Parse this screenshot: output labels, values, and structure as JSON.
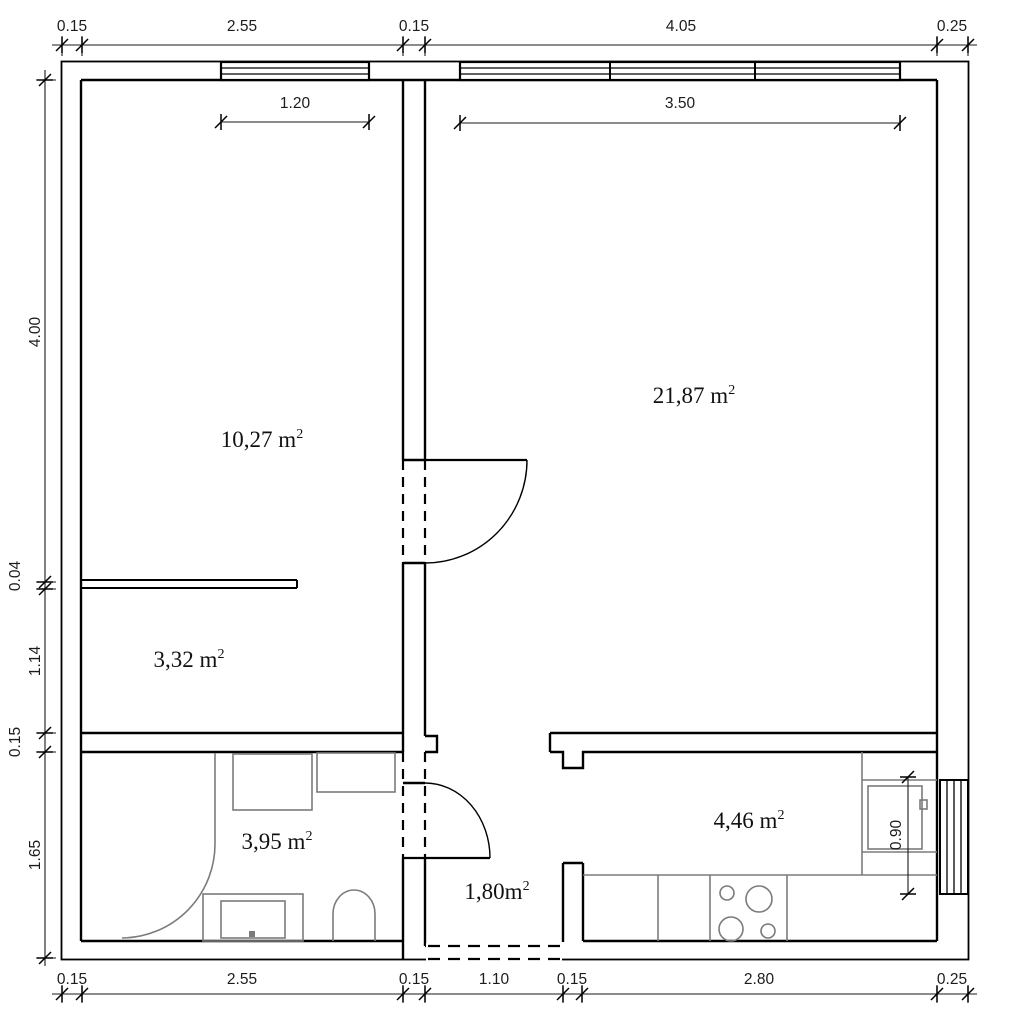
{
  "drawing_title": "apartment-floor-plan",
  "rooms": [
    {
      "id": "room-large-left",
      "area": "10,27 m",
      "sup": "2"
    },
    {
      "id": "living-room",
      "area": "21,87 m",
      "sup": "2"
    },
    {
      "id": "alcove",
      "area": "3,32 m",
      "sup": "2"
    },
    {
      "id": "bathroom",
      "area": "3,95 m",
      "sup": "2"
    },
    {
      "id": "hallway",
      "area": "1,80m",
      "sup": "2"
    },
    {
      "id": "kitchen",
      "area": "4,46 m",
      "sup": "2"
    }
  ],
  "dims": {
    "top": [
      "0.15",
      "2.55",
      "0.15",
      "4.05",
      "0.25"
    ],
    "left": [
      "4.00",
      "0.04",
      "1.14",
      "0.15",
      "1.65"
    ],
    "bottom": [
      "0.15",
      "2.55",
      "0.15",
      "1.10",
      "0.15",
      "2.80",
      "0.25"
    ],
    "interior": {
      "left_window": "1.20",
      "right_window": "3.50",
      "kitchen_sink": "0.90"
    }
  },
  "colors": {
    "wall_line": "#000000",
    "fixture_line": "#7b7b7b",
    "dim_line": "#1a1a1a",
    "text": "#1a1a1a",
    "background": "#ffffff"
  }
}
